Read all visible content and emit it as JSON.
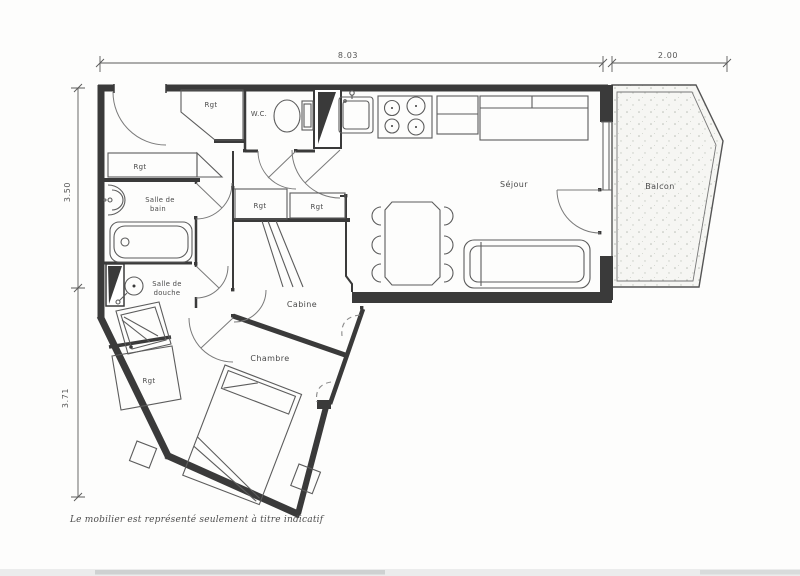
{
  "plan": {
    "note": "Le mobilier est représenté seulement à titre indicatif",
    "dimensions": {
      "top_main": "8.03",
      "top_balcony": "2.00",
      "left_upper": "3.50",
      "left_lower": "3.71"
    },
    "rooms": {
      "wc": "W.C.",
      "sejour": "Séjour",
      "balcon": "Balcon",
      "salle_de_bain_l1": "Salle de",
      "salle_de_bain_l2": "bain",
      "salle_de_douche_l1": "Salle de",
      "salle_de_douche_l2": "douche",
      "cabine": "Cabine",
      "chambre": "Chambre"
    },
    "closets": {
      "rgt1": "Rgt",
      "rgt2": "Rgt",
      "rgt3": "Rgt",
      "rgt4": "Rgt",
      "rgt5": "Rgt"
    },
    "colors": {
      "wall": "#3a3a3a",
      "furniture": "#5c5c5c",
      "label": "#4a4a4a",
      "paper": "#fdfdfc"
    }
  }
}
